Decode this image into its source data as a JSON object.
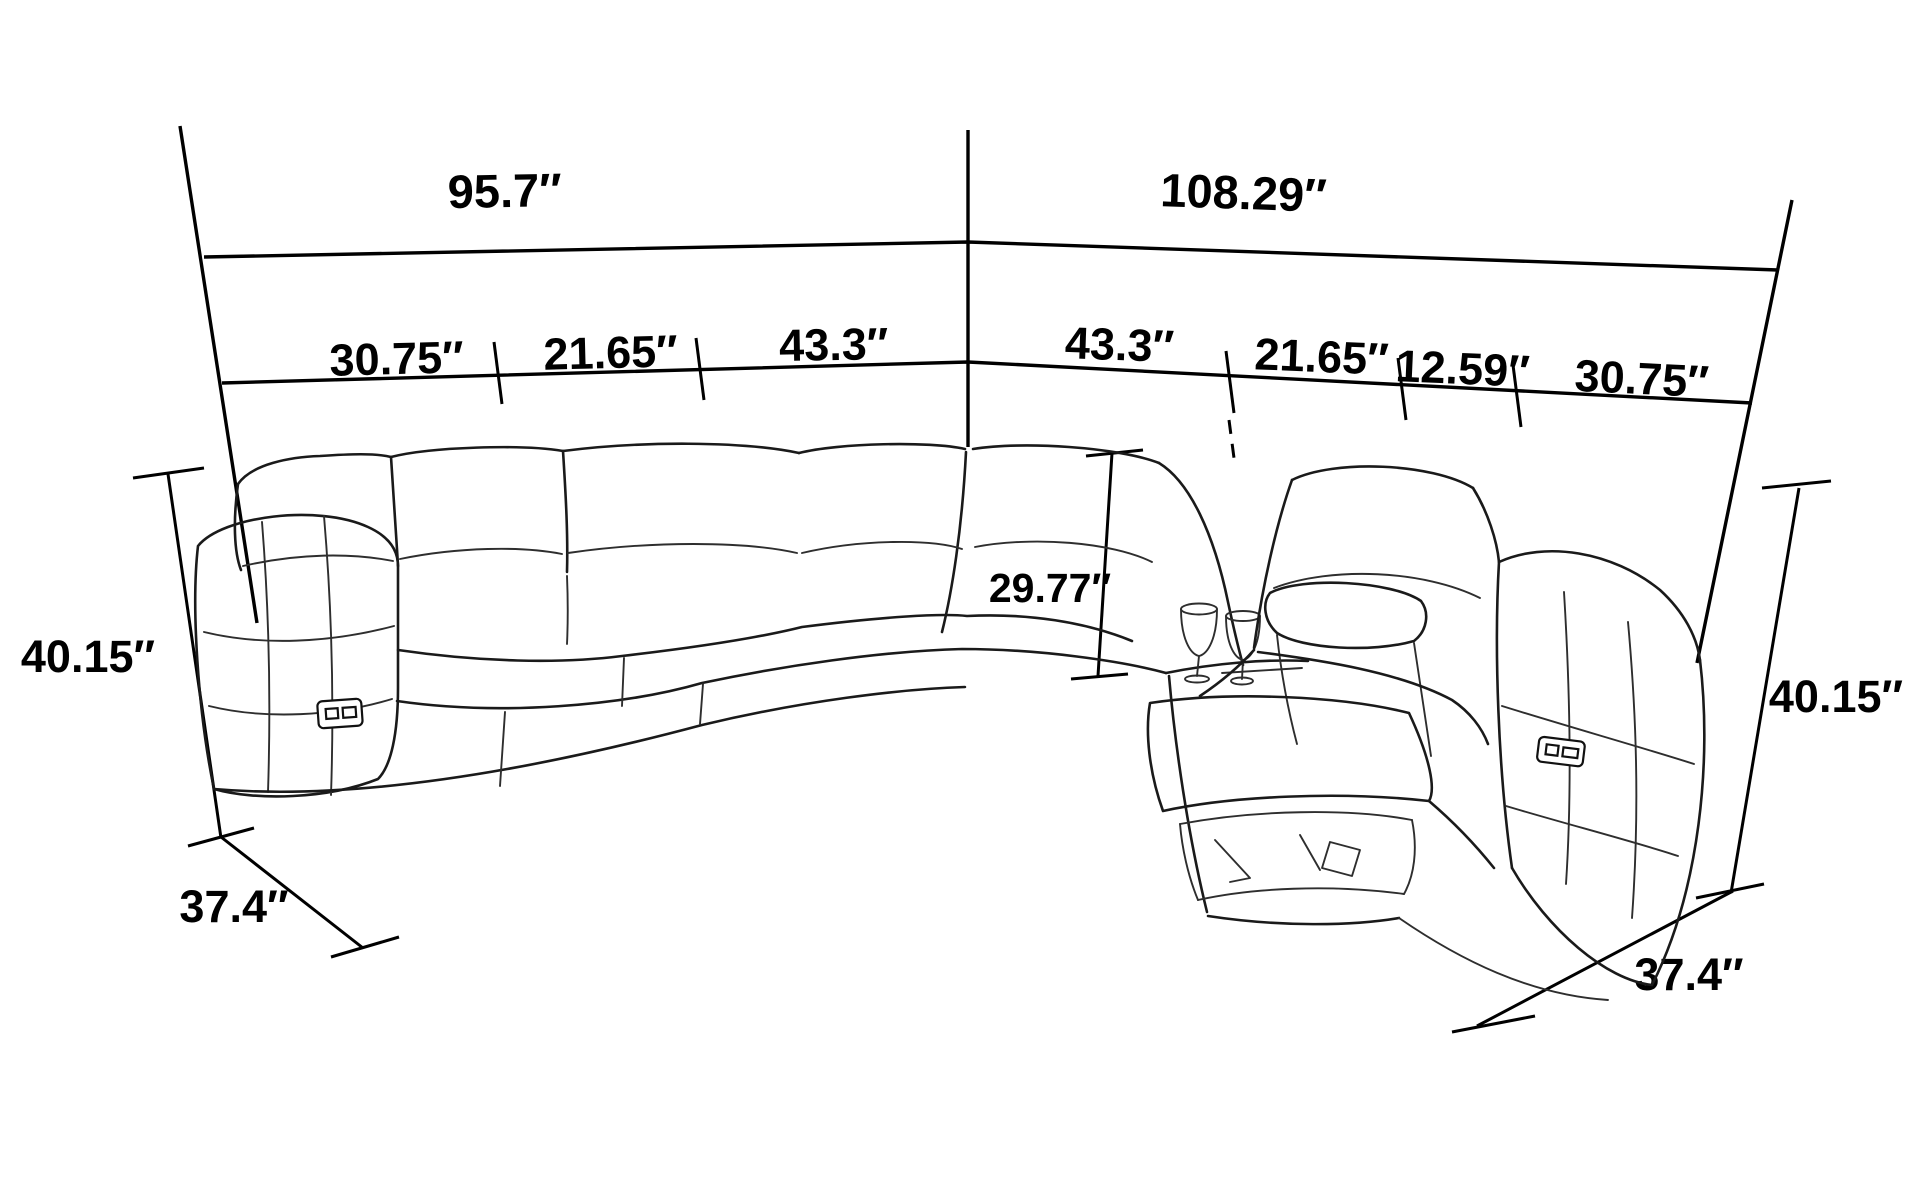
{
  "diagram": {
    "subject": "corner sectional sofa with power recliners and cup-holder console — dimension line drawing",
    "unit": "inches",
    "colors": {
      "line": "#000000",
      "background": "#ffffff"
    },
    "labels": {
      "total_width_left": "95.7″",
      "total_width_right": "108.29″",
      "seg_left_arm": "30.75″",
      "seg_left_seat": "21.65″",
      "seg_left_wide": "43.3″",
      "seg_right_wide": "43.3″",
      "seg_right_seat": "21.65″",
      "seg_console": "12.59″",
      "seg_right_arm": "30.75″",
      "back_cushion_height": "29.77″",
      "overall_height_left": "40.15″",
      "overall_height_right": "40.15″",
      "depth_left": "37.4″",
      "depth_right": "37.4″"
    }
  }
}
